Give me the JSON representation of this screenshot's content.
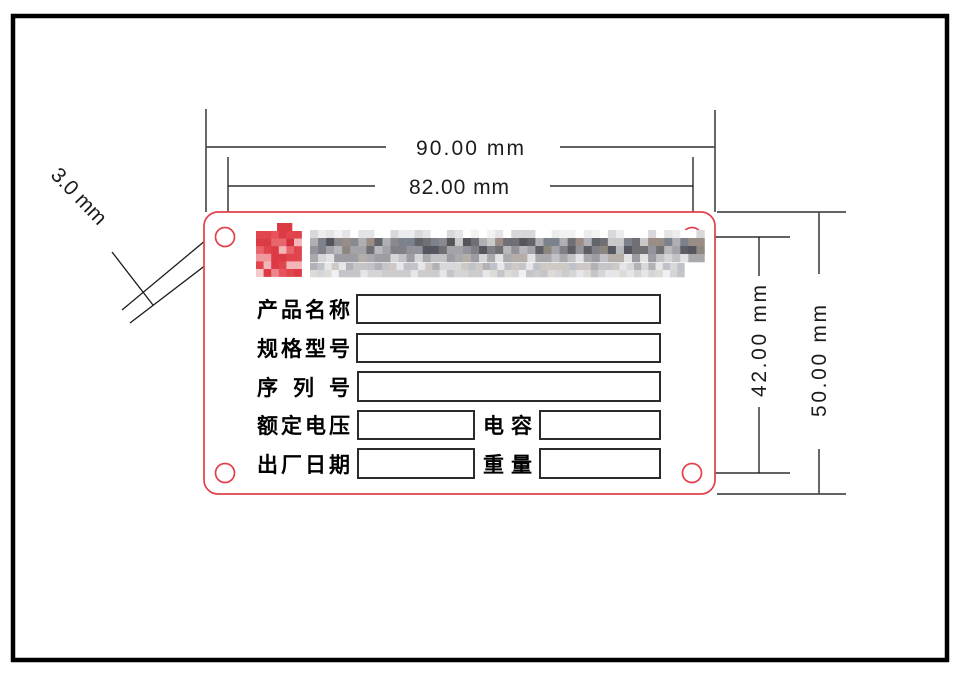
{
  "dimensions": {
    "outer_width": "90.00 mm",
    "hole_spacing_width": "82.00 mm",
    "hole_spacing_height": "42.00 mm",
    "outer_height": "50.00 mm",
    "hole_diameter": "3.0 mm"
  },
  "nameplate": {
    "fields": {
      "row1": {
        "label": "产品名称"
      },
      "row2": {
        "label": "规格型号"
      },
      "row3": {
        "label": "序 列 号"
      },
      "row4": {
        "label": "额定电压",
        "label2": "电容"
      },
      "row5": {
        "label": "出厂日期",
        "label2": "重量"
      }
    }
  },
  "colors": {
    "plate_outline": "#e2404a",
    "dimension_line": "#4d4d4d",
    "leader_line": "#1a1a1a",
    "field_box_stroke": "#2b2b2b",
    "dimension_text": "#1c1c1c",
    "frame": "#000000",
    "logo_red": "#dc3b45"
  },
  "mosaics": [
    {
      "name": "logo-mark-mosaic",
      "x": 256,
      "y": 231,
      "pw": 7.6,
      "ph": 7.6,
      "cols": 6,
      "rows": 6,
      "seed": 7,
      "rowPalettes": [
        [
          "#e8525a",
          "#dc3b45",
          "#e0454e",
          "#ef9094",
          "#dc3b45"
        ],
        [
          "#dc3b45",
          "#d2323e",
          "#e8656c",
          "#f3b5b8",
          "#dc3b45"
        ],
        [
          "#e0454e",
          "#f3b5b8",
          "#dc3b45",
          "#e8656c",
          "#d2323e"
        ],
        [
          "#dc3b45",
          "#e8656c",
          "#f0999d",
          "#d2323e",
          "#e0454e"
        ],
        [
          "#e0454e",
          "#dc3b45",
          "#f3b5b8",
          "#e8525a",
          "#dc3b45"
        ],
        [
          "#ee858a",
          "#dc3b45",
          "#e0454e",
          "#f6caca",
          "#e8525a"
        ]
      ]
    },
    {
      "name": "logo-tab-mosaic",
      "x": 277,
      "y": 223,
      "pw": 7.5,
      "ph": 8.5,
      "cols": 2,
      "rows": 1,
      "seed": 3,
      "rowPalettes": [
        [
          "#dc3b45",
          "#e8525a"
        ]
      ]
    },
    {
      "name": "company-line1-mosaic",
      "x": 310,
      "y": 230,
      "pw": 8.05,
      "ph": 8,
      "cols": 49,
      "rows": 4,
      "seed": 11,
      "rowPalettes": [
        [
          "#f2f2f2",
          "#e4e4e6",
          "#ffffff",
          "#d8d8da",
          "#ffffff",
          "#ececee"
        ],
        [
          "#6f6f74",
          "#8a8a8e",
          "#55555c",
          "#b0b0b4",
          "#9a8d86",
          "#7c828c",
          "#c9c9cb",
          "#63636a"
        ],
        [
          "#808086",
          "#5d5d64",
          "#a4a4a8",
          "#6f6f74",
          "#8e8780",
          "#b9b9bd",
          "#565660",
          "#93939b"
        ],
        [
          "#c2c2c6",
          "#a9a9ad",
          "#d5d5d7",
          "#b5aea8",
          "#9c9ca2",
          "#e2e2e4"
        ]
      ]
    },
    {
      "name": "company-line2-mosaic",
      "x": 310,
      "y": 263,
      "pw": 7.2,
      "ph": 7,
      "cols": 52,
      "rows": 2,
      "seed": 5,
      "rowPalettes": [
        [
          "#c5c5c9",
          "#d8d8da",
          "#b2b2b6",
          "#e6e6e8",
          "#cfc9c5",
          "#bfc3c9"
        ],
        [
          "#d5d5d7",
          "#c5c5c9",
          "#e6e6e8",
          "#dedad6",
          "#ccccce",
          "#f0f0f2"
        ]
      ]
    }
  ]
}
